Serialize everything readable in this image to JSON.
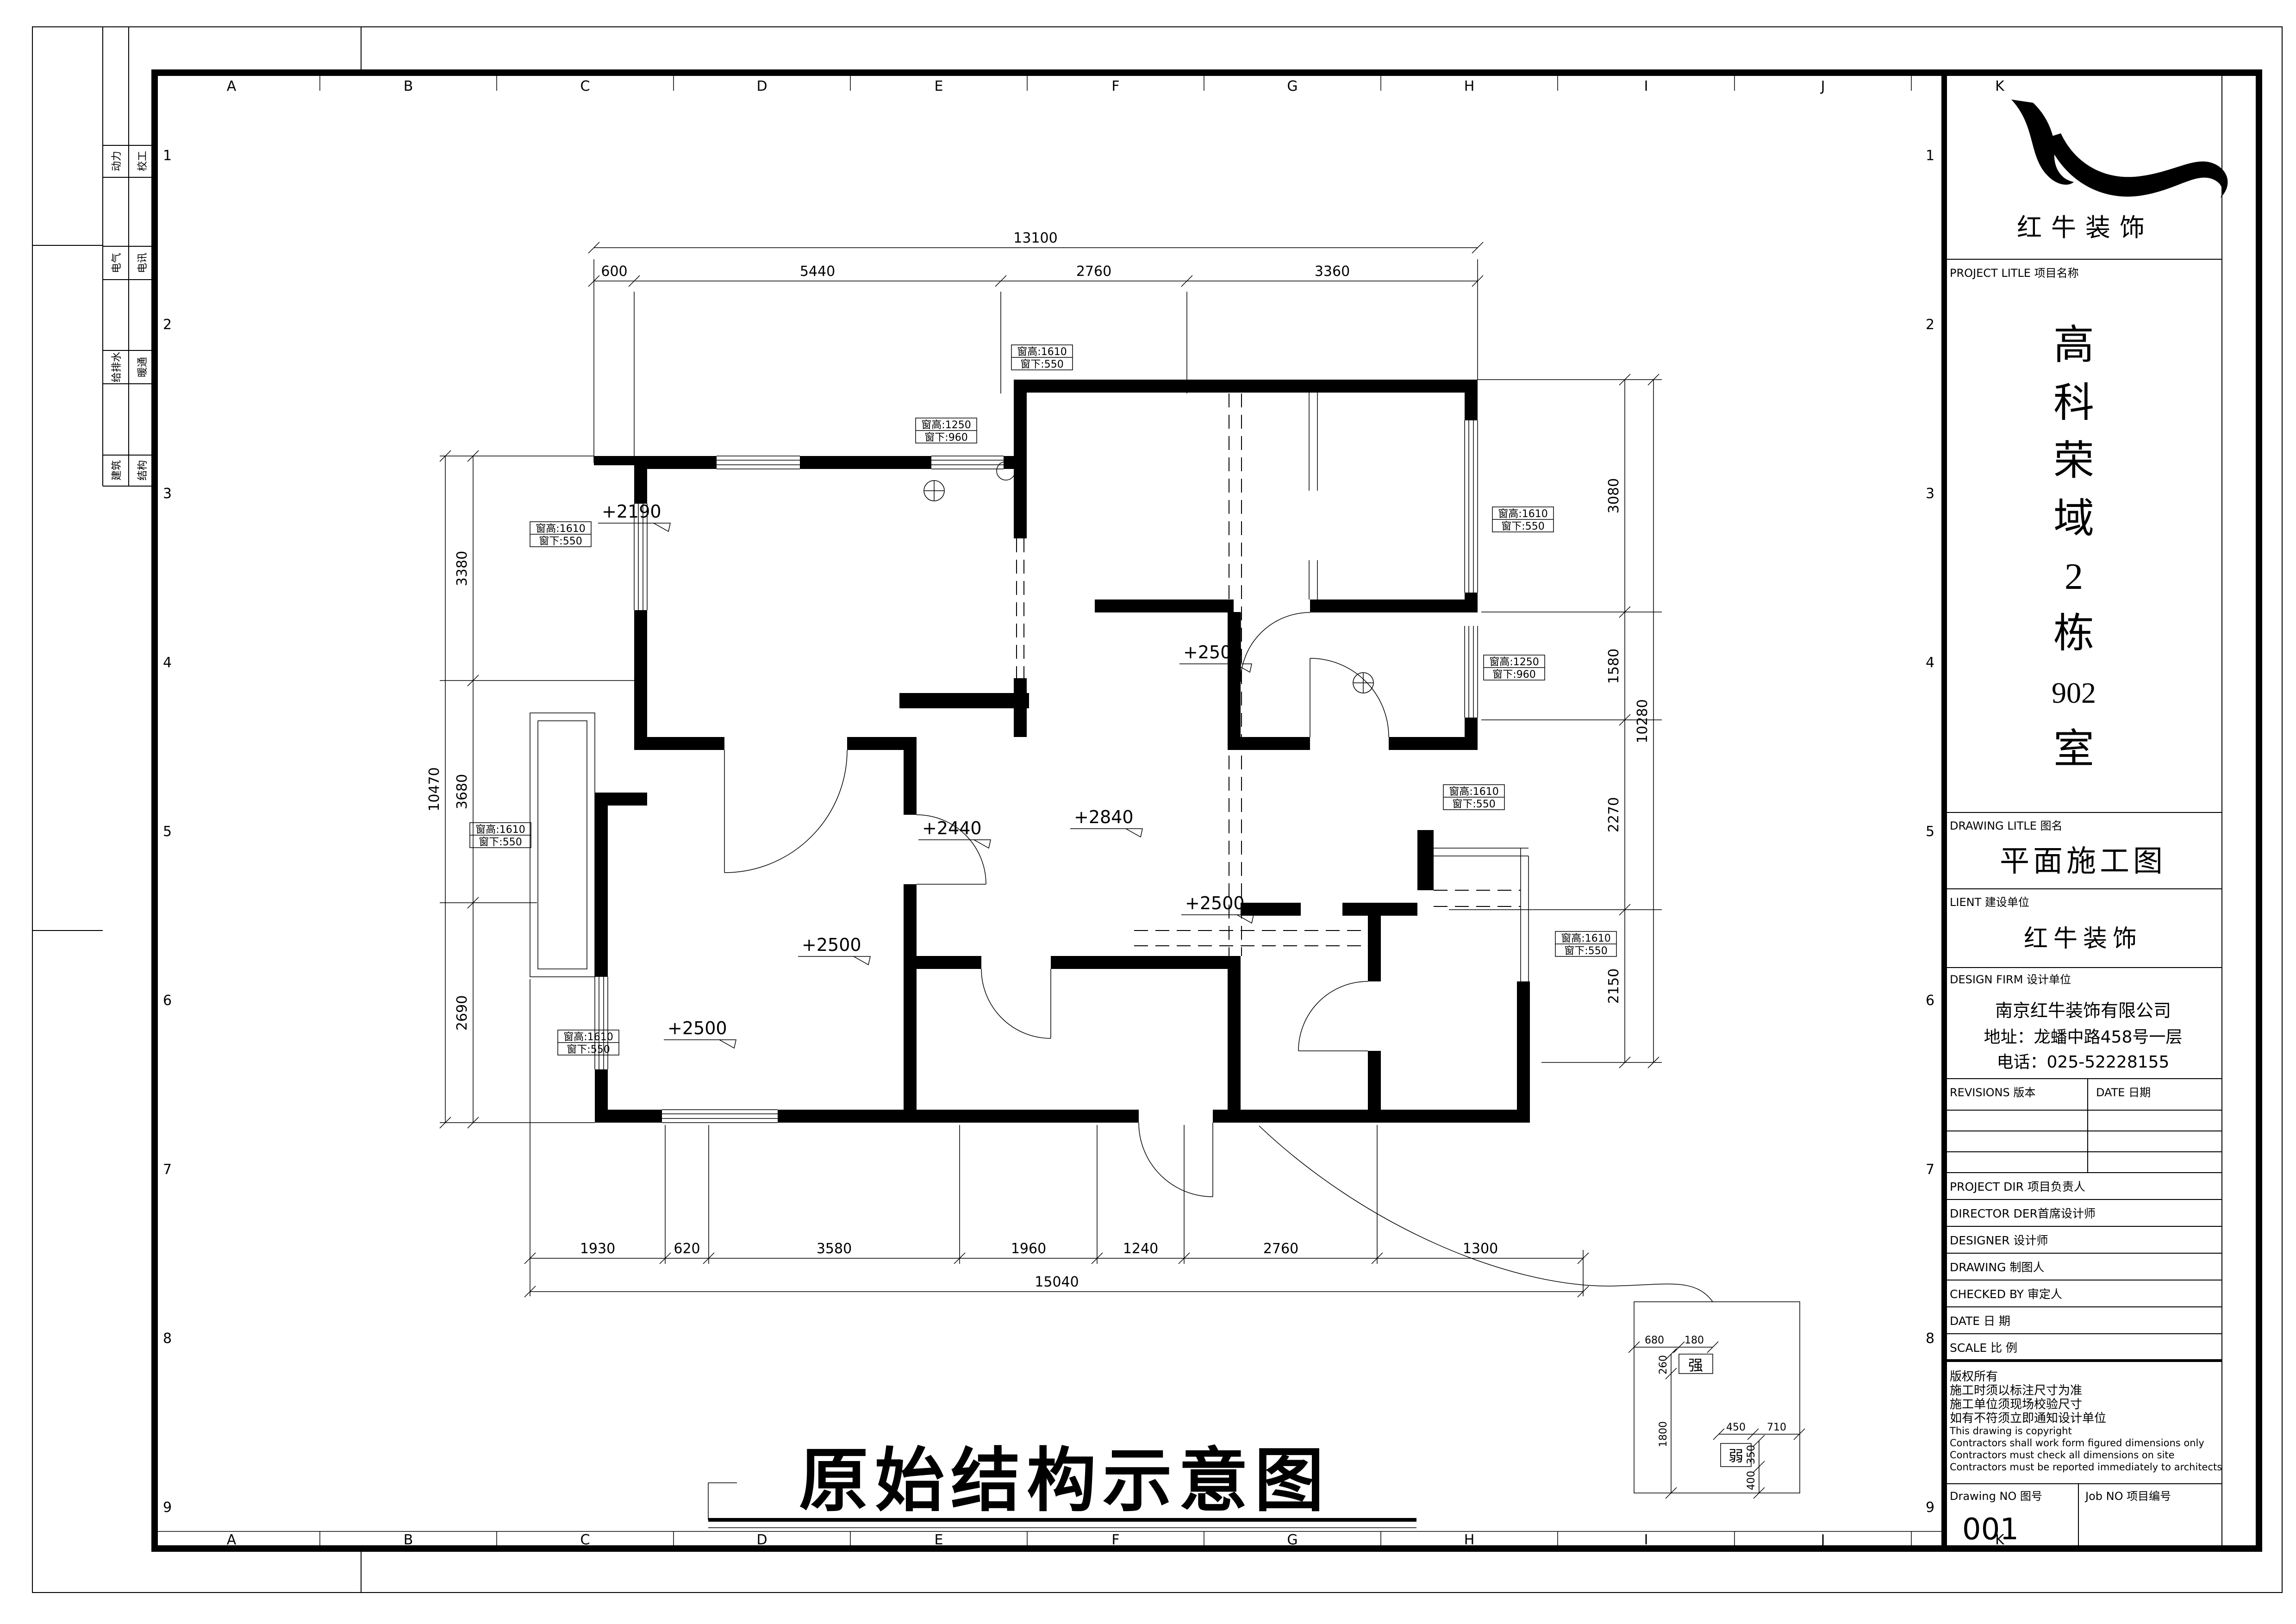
{
  "sheet": {
    "grid_letters": [
      "A",
      "B",
      "C",
      "D",
      "E",
      "F",
      "G",
      "H",
      "I",
      "J",
      "K"
    ],
    "grid_numbers": [
      "1",
      "2",
      "3",
      "4",
      "5",
      "6",
      "7",
      "8",
      "9"
    ],
    "disciplines": [
      {
        "a": "动力",
        "b": "校工"
      },
      {
        "a": "电气",
        "b": "电讯"
      },
      {
        "a": "给排水",
        "b": "暖通"
      },
      {
        "a": "建筑",
        "b": "结构"
      }
    ]
  },
  "plan": {
    "title": "原始结构示意图",
    "dims": {
      "top_overall": "13100",
      "top": [
        "600",
        "5440",
        "2760",
        "3360"
      ],
      "bottom": [
        "1930",
        "620",
        "3580",
        "1960",
        "1240",
        "2760",
        "1300"
      ],
      "bottom_overall": "15040",
      "left": [
        "3380",
        "3680",
        "2690"
      ],
      "left_overall": "10470",
      "right": [
        "3080",
        "1580",
        "2270",
        "2150"
      ],
      "right_overall": "10280"
    },
    "levels": [
      {
        "v": "+2190"
      },
      {
        "v": "+2440"
      },
      {
        "v": "+2840"
      },
      {
        "v": "+2500"
      },
      {
        "v": "+2500"
      },
      {
        "v": "+2500"
      },
      {
        "v": "+2500"
      }
    ],
    "window_labels": [
      {
        "h": "窗高:1610",
        "s": "窗下:550"
      },
      {
        "h": "窗高:1250",
        "s": "窗下:960"
      },
      {
        "h": "窗高:1610",
        "s": "窗下:550"
      },
      {
        "h": "窗高:1610",
        "s": "窗下:550"
      },
      {
        "h": "窗高:1250",
        "s": "窗下:960"
      },
      {
        "h": "窗高:1610",
        "s": "窗下:550"
      },
      {
        "h": "窗高:1610",
        "s": "窗下:550"
      },
      {
        "h": "窗高:1610",
        "s": "窗下:550"
      },
      {
        "h": "窗高:1610",
        "s": "窗下:550"
      }
    ]
  },
  "detail": {
    "strong": "强",
    "weak": "弱",
    "dims": [
      "680",
      "180",
      "260",
      "1800",
      "450",
      "710",
      "350",
      "400"
    ]
  },
  "titleblock": {
    "brand": "红牛装饰",
    "project_label": "PROJECT LITLE 项目名称",
    "project_name": [
      "高",
      "科",
      "荣",
      "域",
      "2",
      "栋",
      "902",
      "室"
    ],
    "drawing_title_label": "DRAWING LITLE 图名",
    "drawing_title": "平面施工图",
    "client_label": "LIENT 建设单位",
    "client": "红牛装饰",
    "firm_label": "DESIGN FIRM 设计单位",
    "firm_name": "南京红牛装饰有限公司",
    "firm_address": "地址：龙蟠中路458号一层",
    "firm_phone": "电话：025-52228155",
    "revisions_label": "REVISIONS 版本",
    "revisions_date_label": "DATE 日期",
    "rows": [
      "PROJECT DIR   项目负责人",
      "DIRECTOR DER首席设计师",
      "DESIGNER      设计师",
      "DRAWING       制图人",
      "CHECKED BY   审定人",
      "DATE          日  期",
      "SCALE         比  例"
    ],
    "copyright": [
      "版权所有",
      "施工时须以标注尺寸为准",
      "施工单位须现场校验尺寸",
      "如有不符须立即通知设计单位",
      "This drawing is copyright",
      "Contractors shall work form figured dimensions only",
      "Contractors must check all dimensions on site",
      "Contractors must be reported immediately to architects"
    ],
    "drawing_no_label": "Drawing NO 图号",
    "drawing_no": "001",
    "job_no_label": "Job NO 项目编号"
  }
}
